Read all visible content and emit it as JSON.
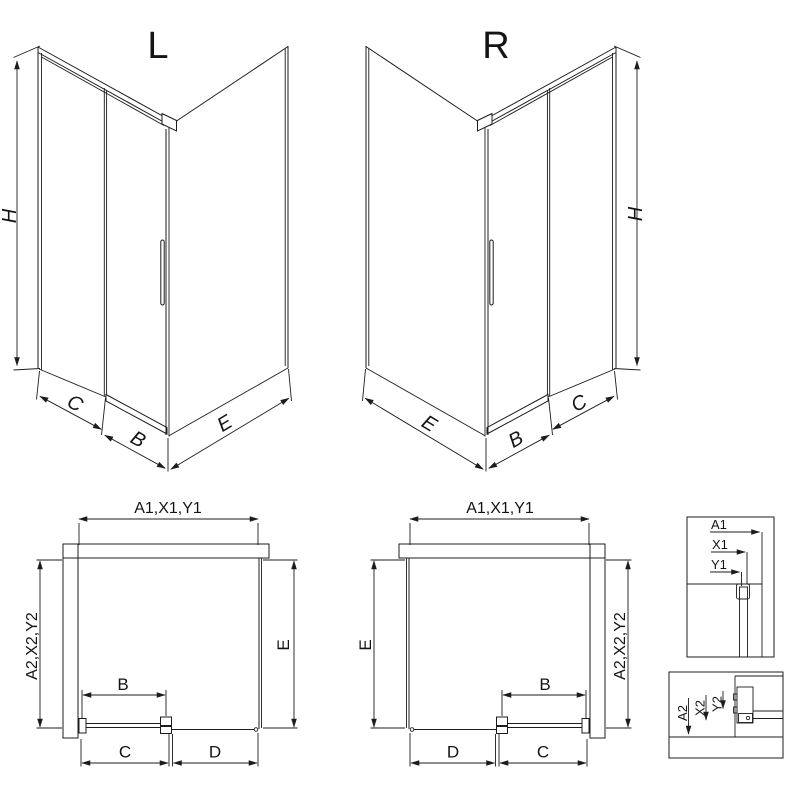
{
  "page": {
    "background": "#ffffff",
    "line_color": "#1c1c1c"
  },
  "views": {
    "iso_left": {
      "title": "L",
      "dim_height": "H",
      "dim_fixed": "C",
      "dim_door": "B",
      "dim_side": "E"
    },
    "iso_right": {
      "title": "R",
      "dim_height": "H",
      "dim_fixed": "C",
      "dim_door": "B",
      "dim_side": "E"
    },
    "plan_left": {
      "dim_top": "A1,X1,Y1",
      "dim_left": "A2,X2,Y2",
      "dim_right": "E",
      "dim_door": "B",
      "dim_bottom_left": "C",
      "dim_bottom_right": "D"
    },
    "plan_right": {
      "dim_top": "A1,X1,Y1",
      "dim_left": "E",
      "dim_right": "A2,X2,Y2",
      "dim_door": "B",
      "dim_bottom_left": "D",
      "dim_bottom_right": "C"
    },
    "detail_top": {
      "labels": [
        "A1",
        "X1",
        "Y1"
      ]
    },
    "detail_bottom": {
      "labels": [
        "A2",
        "X2",
        "Y2"
      ]
    }
  }
}
